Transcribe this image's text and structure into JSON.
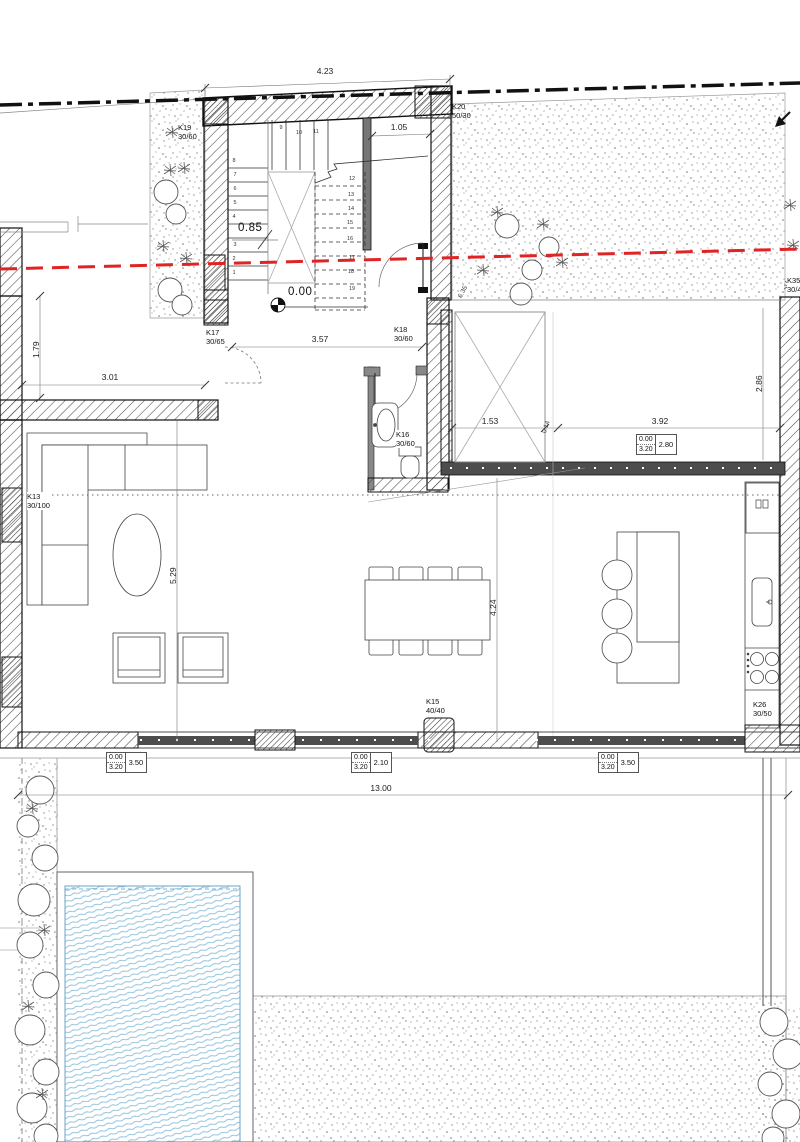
{
  "drawing_type": "ground-floor architectural plan",
  "levels": {
    "ground": "0.00",
    "stair_landing": "0.85"
  },
  "stairs": [
    "1",
    "2",
    "3",
    "4",
    "5",
    "6",
    "7",
    "8",
    "9",
    "10",
    "11",
    "12",
    "13",
    "14",
    "15",
    "16",
    "17",
    "18",
    "19"
  ],
  "columns": {
    "k13": {
      "id": "K13",
      "size": "30/100"
    },
    "k15": {
      "id": "K15",
      "size": "40/40"
    },
    "k16": {
      "id": "K16",
      "size": "30/60"
    },
    "k17": {
      "id": "K17",
      "size": "30/65"
    },
    "k18": {
      "id": "K18",
      "size": "30/60"
    },
    "k19": {
      "id": "K19",
      "size": "30/60"
    },
    "k20": {
      "id": "K20",
      "size": "50/30"
    },
    "k26": {
      "id": "K26",
      "size": "30/50"
    },
    "k35": {
      "id": "K35",
      "size": "30/40"
    }
  },
  "dims": {
    "top_width": "4.23",
    "vestibule_width": "1.05",
    "hall_width": "3.57",
    "porch_height": "1.79",
    "porch_width": "3.01",
    "void_width": "1.53",
    "wall_offset": "0.14",
    "patio_width": "3.92",
    "patio_height": "2.86",
    "living_height": "5.29",
    "dining_height": "4.24",
    "total_width": "13.00",
    "site_note": "6.35"
  },
  "window_tags": {
    "patio": {
      "sill": "0.00",
      "head": "3.20",
      "width": "2.80"
    },
    "left": {
      "sill": "0.00",
      "head": "3.20",
      "width": "3.50"
    },
    "center": {
      "sill": "0.00",
      "head": "3.20",
      "width": "2.10"
    },
    "right": {
      "sill": "0.00",
      "head": "3.20",
      "width": "3.50"
    }
  },
  "colors": {
    "boundary_red": "#e02424",
    "pool_blue": "#8fc1dc",
    "wall_dark": "#4d4d4d"
  }
}
